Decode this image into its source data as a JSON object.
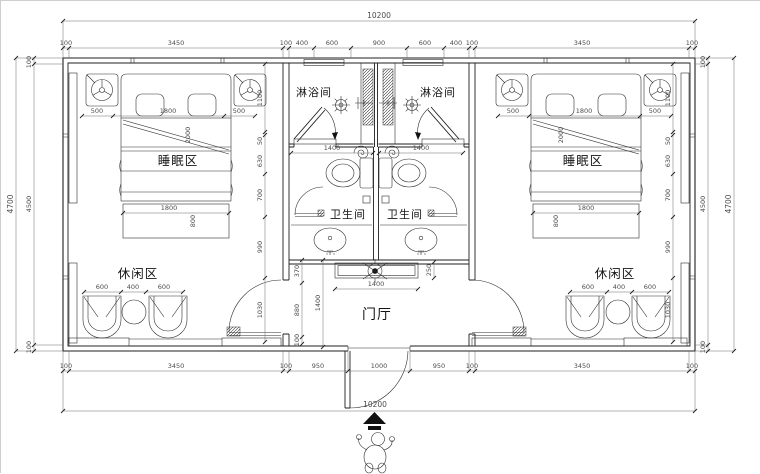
{
  "title": "室内平面布置图",
  "labels": {
    "shower_left": "淋浴间",
    "shower_right": "淋浴间",
    "toilet_left": "卫生间",
    "toilet_right": "卫生间",
    "sleep_left": "睡眠区",
    "sleep_right": "睡眠区",
    "leisure_left": "休闲区",
    "leisure_right": "休闲区",
    "foyer": "门厅"
  },
  "dims": {
    "top_total": "10200",
    "top_chain": [
      "100",
      "3450",
      "100",
      "400",
      "600",
      "900",
      "600",
      "400",
      "100",
      "3450",
      "100"
    ],
    "bottom_chain": [
      "100",
      "3450",
      "100",
      "950",
      "1000",
      "950",
      "100",
      "3450",
      "100"
    ],
    "bottom_total": "10200",
    "left_outer": "4700",
    "left_chain": [
      "100",
      "4500",
      "100"
    ],
    "right_chain": [
      "100",
      "4500",
      "100"
    ],
    "right_outer": "4700",
    "bed_left": [
      "500",
      "1800",
      "500"
    ],
    "bed_right": [
      "500",
      "1800",
      "500"
    ],
    "bed_left_foot": {
      "w": "1800",
      "d": "800"
    },
    "bed_right_foot": {
      "w": "1800",
      "d": "800"
    },
    "bed_left_len": "2000",
    "bed_right_len": "2000",
    "leisure_left": [
      "600",
      "400",
      "600"
    ],
    "leisure_right": [
      "600",
      "400",
      "600"
    ],
    "wc_left": "1400",
    "wc_right": "1400",
    "console_w": "1400",
    "console_d": "250",
    "hall_chain": [
      "370",
      "880",
      "100"
    ],
    "hall_h": "1400",
    "room_left_chain": [
      "1100",
      "50",
      "630",
      "700",
      "990",
      "1030"
    ],
    "room_right_chain": [
      "1100",
      "50",
      "630",
      "700",
      "990",
      "1030"
    ]
  },
  "colors": {
    "line": "#1f1f1f",
    "dim_text": "#4c4c4c",
    "background": "#ffffff"
  }
}
